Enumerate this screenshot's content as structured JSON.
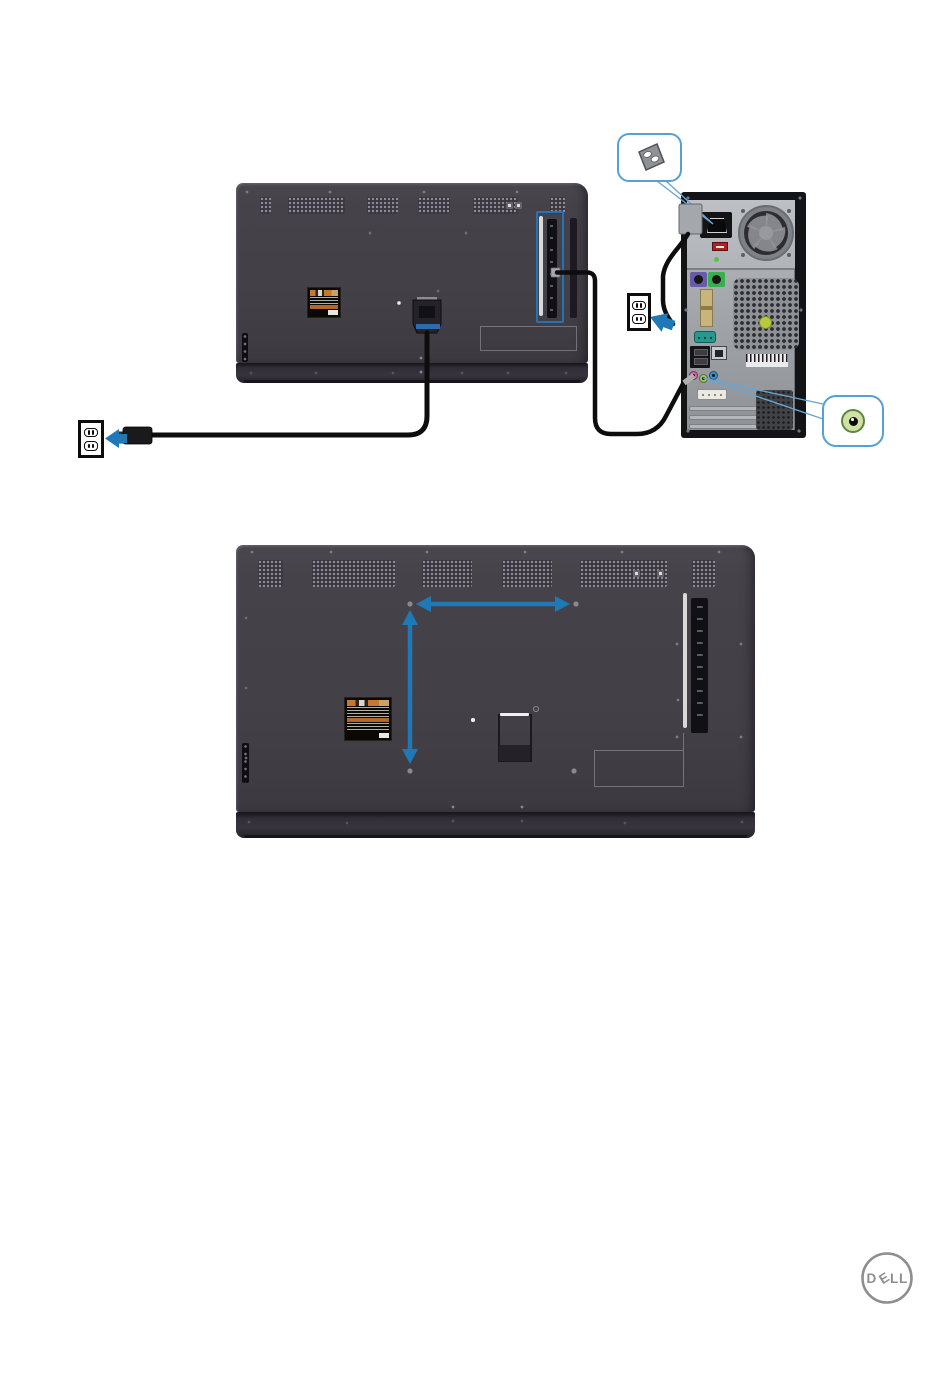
{
  "page": {
    "background": "#ffffff"
  },
  "colors": {
    "monitor_body": "#46424a",
    "monitor_bottom_bar": "#312d38",
    "highlight_box": "#2472b8",
    "arrow_blue": "#1e79b6",
    "callout_border": "#55a0d6",
    "pointer_line": "#6aa5d2",
    "cable_black": "#0d0d0d",
    "pc_case": "#131417",
    "pc_panel": "#abaeb2",
    "audio_jack_green_fill": "#cfe2a6",
    "audio_jack_green_ring": "#5f8440",
    "audio_jack_pink": "#df5f9d",
    "audio_jack_blue": "#3f8fcc",
    "ps2_purple": "#6a5aaa",
    "ps2_green": "#35b04a",
    "voltage_switch_red": "#b02025",
    "logo_gray": "#8e8e90"
  },
  "icons": {
    "power_inlet": "power-inlet-icon",
    "power_outlet": "power-outlet-icon",
    "audio_line_out": "audio-line-out-icon",
    "vesa_arrows": "vesa-dimension-arrows",
    "dell_logo": "dell-logo"
  },
  "logo": {
    "label": "DELL",
    "letters": [
      "D",
      "E",
      "L",
      "L"
    ]
  }
}
